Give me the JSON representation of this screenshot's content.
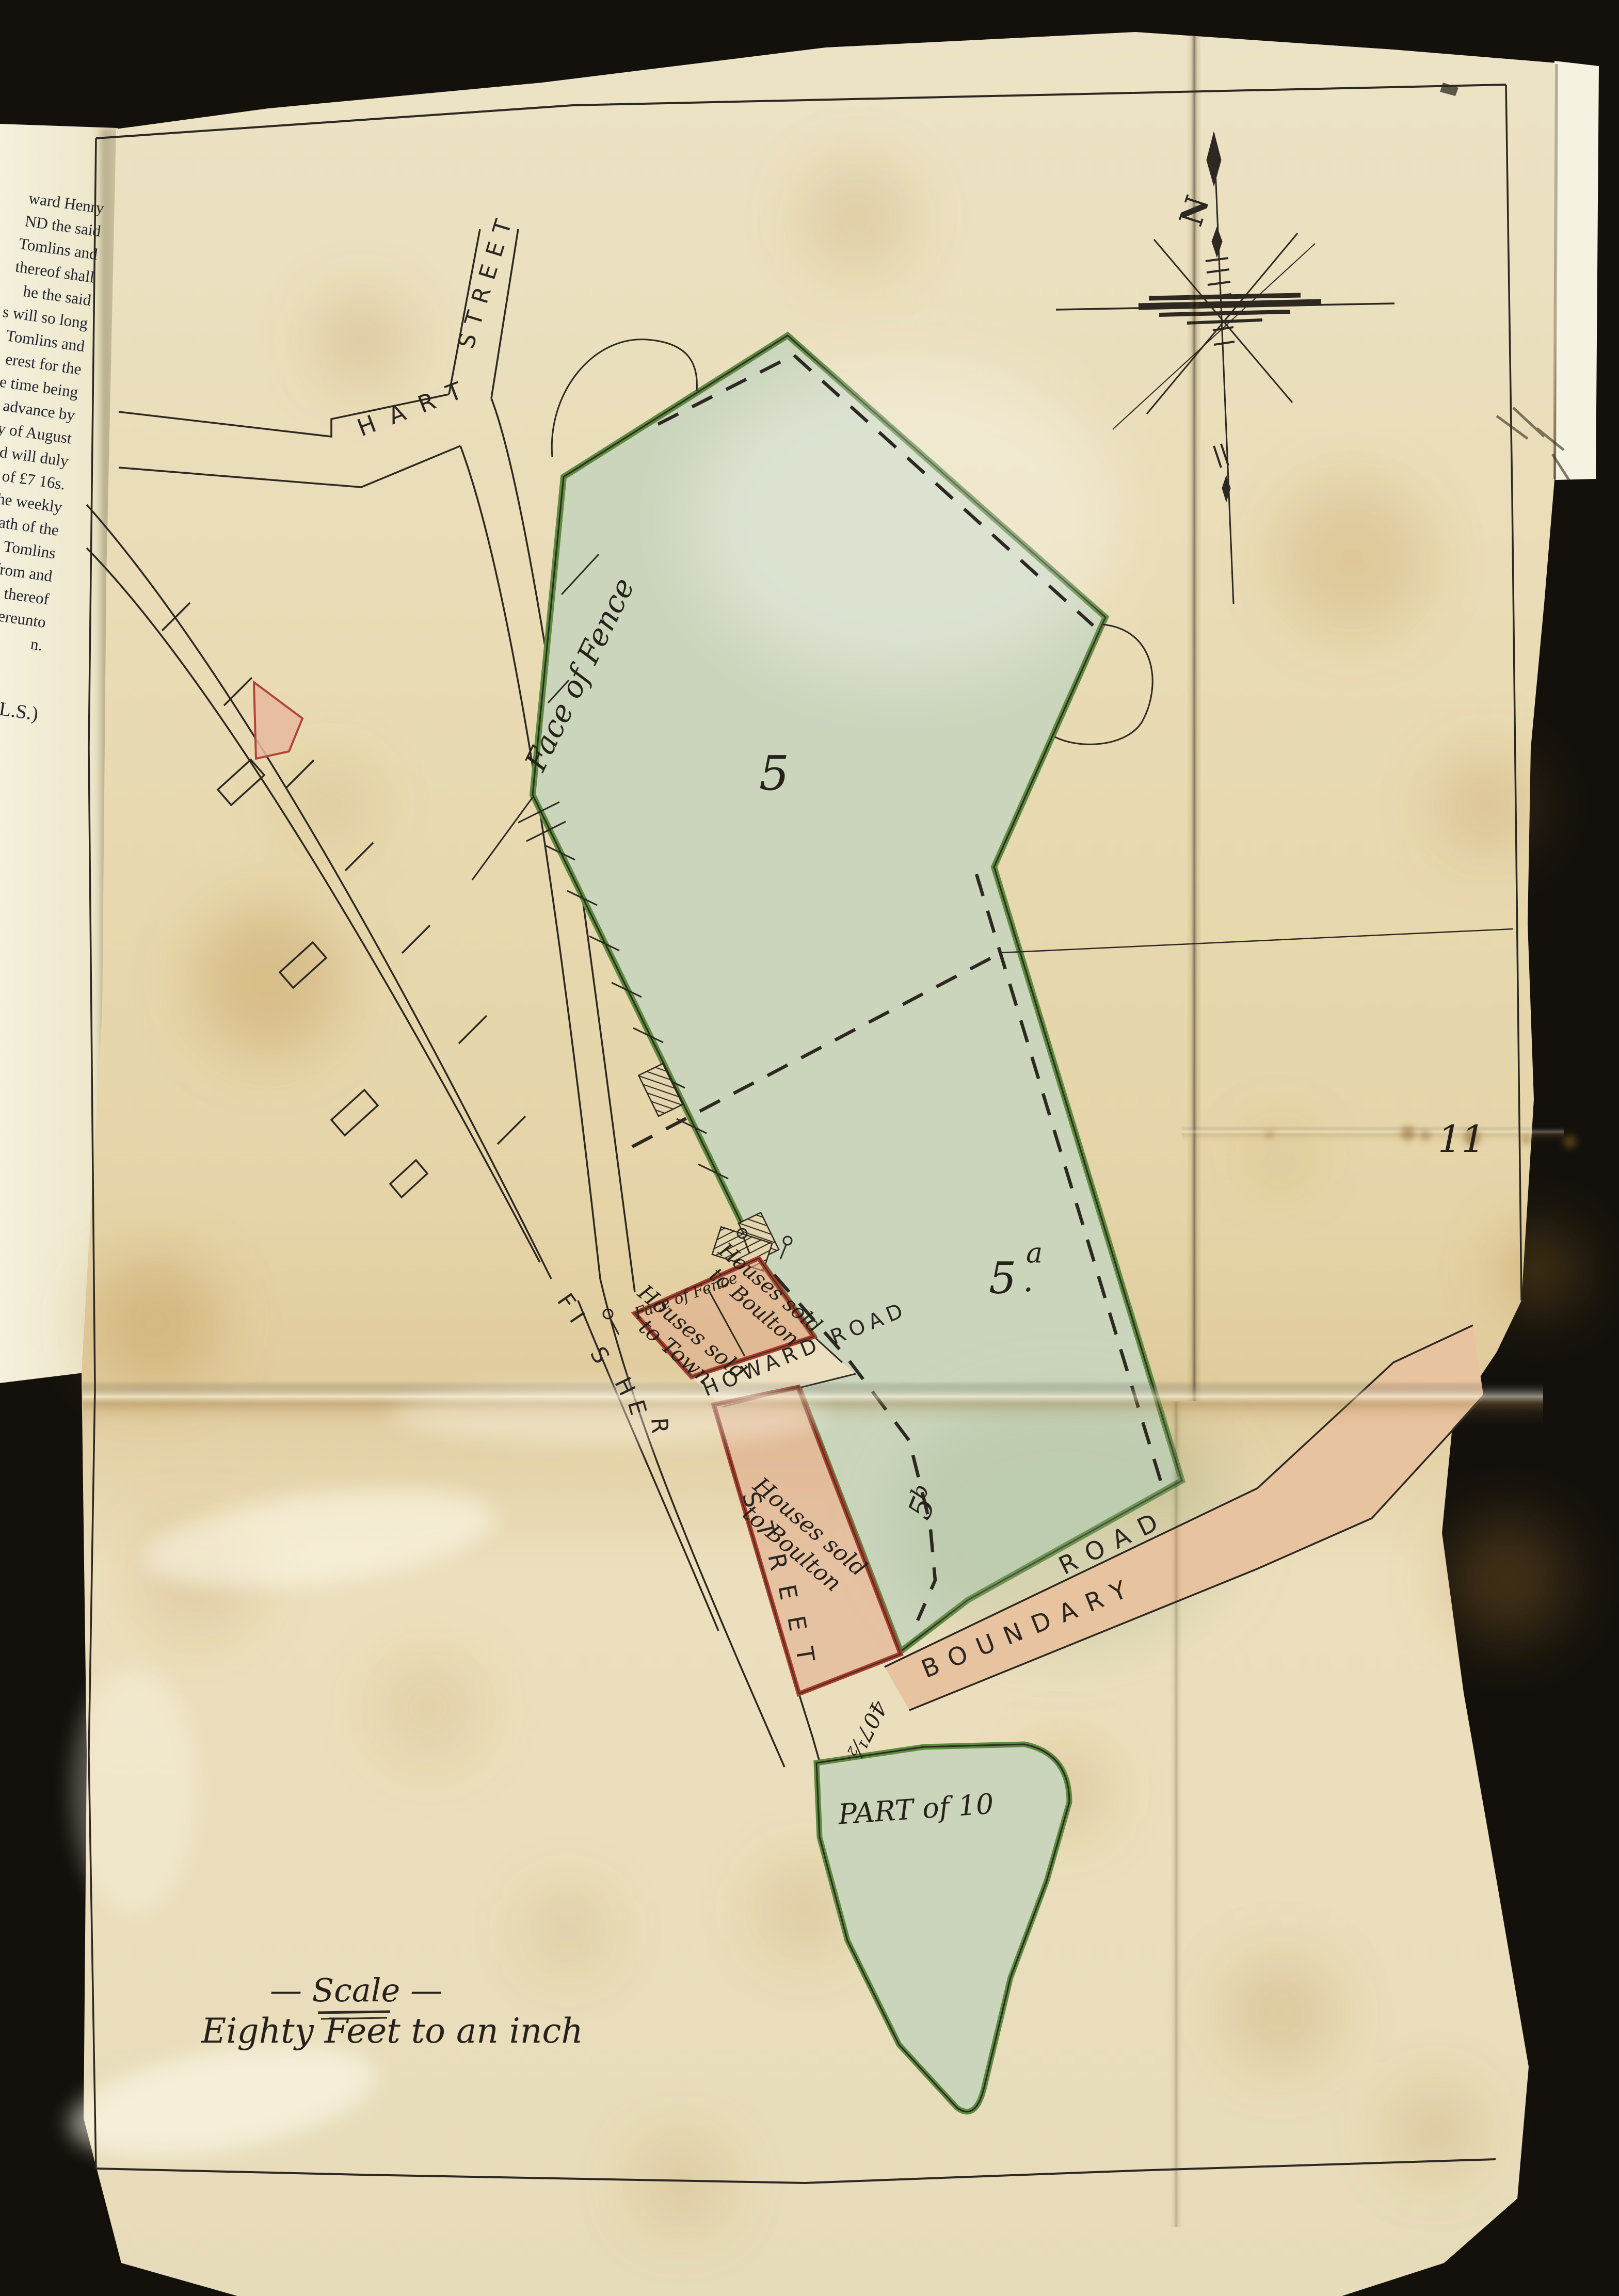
{
  "book_page": {
    "lines": [
      "ward Henry",
      "ND the said",
      "Tomlins and",
      "thereof shall",
      "he the said",
      "s will so long",
      "Tomlins and",
      "erest for the",
      "e time being",
      "advance by",
      "ay of August",
      "nd will duly",
      "y of £7 16s.",
      "the weekly",
      "death of the",
      "mes Tomlins",
      "ns from and",
      "pect thereof",
      "ave hereunto",
      "n."
    ],
    "signature": "ENNY (L.S.)"
  },
  "map": {
    "page_number": "11",
    "streets": {
      "hart": "HART",
      "hart_street": "STREET",
      "fisher_letters": [
        "F",
        "I",
        "S",
        "H",
        "E",
        "R"
      ],
      "fisher_street_letters": [
        "S",
        "T",
        "R",
        "E",
        "E",
        "T"
      ],
      "howard_road": "HOWARD  ROAD",
      "boundary": "BOUNDARY",
      "boundary_road_word": "ROAD"
    },
    "parcels": {
      "five": "5",
      "five_a_base": "5",
      "five_a_sup": "a",
      "five_a_dot": ".",
      "five_b_base": "5",
      "five_b_sup": "b",
      "part_of_ten": "PART of 10"
    },
    "annotations": {
      "face_of_fence_large": "Face of Fence",
      "face_of_fence_small": "Face of Fence",
      "lot1_line1": "Houses sold",
      "lot1_line2": "to Boulton",
      "lot2_line1": "Houses sold",
      "lot2_line2": "to Town",
      "lot3_line1": "Houses sold",
      "lot3_line2": "to Boulton",
      "frontage_number": "407½",
      "compass_north": "N"
    },
    "scale": {
      "title": "— Scale —",
      "subtitle": "Eighty Feet to an inch"
    }
  },
  "colors": {
    "background": "#14110c",
    "paper": "#e9dbb2",
    "book_page": "#f1ecd6",
    "green_fill": "#cbd5bc",
    "green_edge": "#5c8a3e",
    "red_edge": "#a93b2c",
    "pink_wash": "#dd8d60",
    "ink": "#2d2821"
  }
}
